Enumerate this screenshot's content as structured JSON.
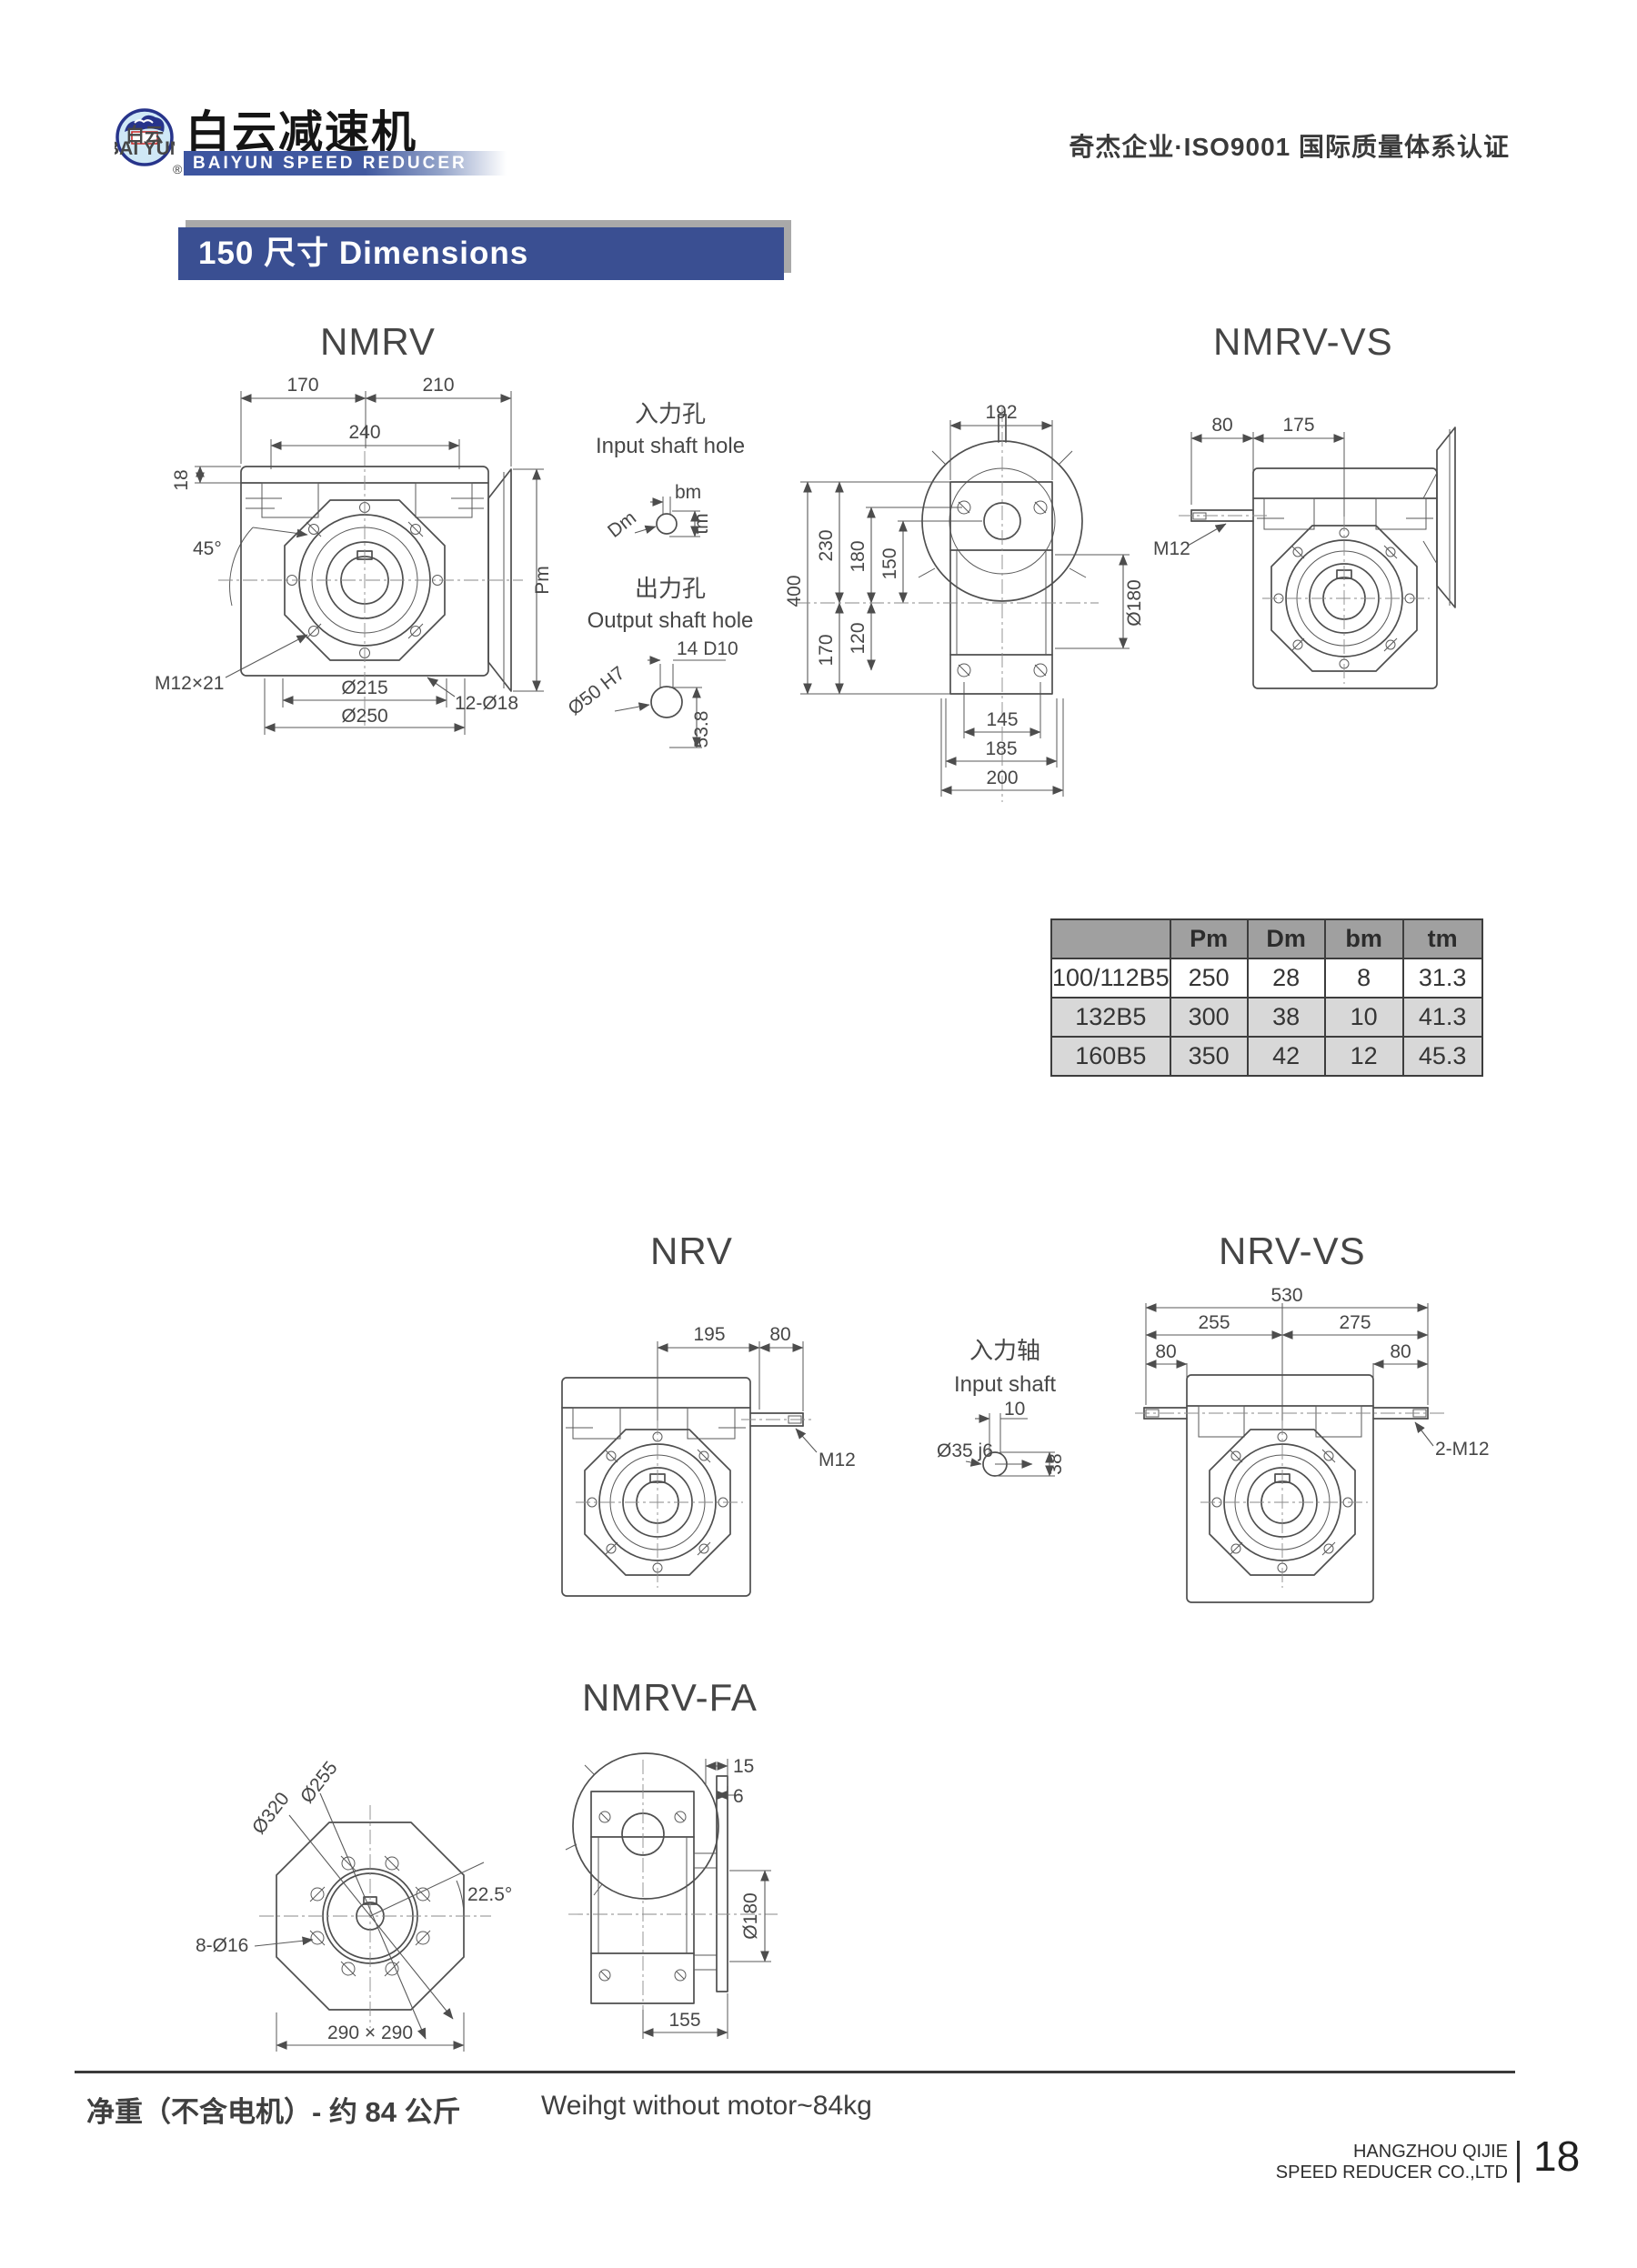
{
  "page": {
    "header": {
      "logo": {
        "badge_cn": "白云",
        "badge_en": "BAI YUN",
        "brand_cn": "白云减速机",
        "brand_en": "BAIYUN SPEED REDUCER",
        "registered": "®"
      },
      "certification": "奇杰企业·ISO9001 国际质量体系认证"
    },
    "section_title": "150 尺寸 Dimensions"
  },
  "nmrv": {
    "title": "NMRV",
    "dims": {
      "w_left": "170",
      "w_right": "210",
      "w_inner": "240",
      "plate": "18",
      "angle": "45°",
      "bolt_spec": "M12×21",
      "bc": "Ø215",
      "od": "Ø250",
      "holes": "12-Ø18",
      "pm": "Pm"
    }
  },
  "shaft_holes": {
    "input_cn": "入力孔",
    "input_en": "Input shaft hole",
    "bm": "bm",
    "dm": "Dm",
    "tm": "tm",
    "output_cn": "出力孔",
    "output_en": "Output shaft hole",
    "key": "14 D10",
    "bore": "Ø50 H7",
    "depth": "53.8"
  },
  "top_view": {
    "dims": {
      "w": "192",
      "h": "400",
      "h1": "230",
      "h2": "180",
      "h3": "150",
      "h4": "120",
      "h5": "170",
      "dia": "Ø180",
      "b1": "145",
      "b2": "185",
      "b3": "200"
    }
  },
  "nmrv_vs": {
    "title": "NMRV-VS",
    "dims": {
      "a": "80",
      "b": "175",
      "m": "M12"
    }
  },
  "nrv": {
    "title": "NRV",
    "dims": {
      "a": "195",
      "b": "80",
      "m": "M12"
    }
  },
  "input_shaft": {
    "cn": "入力轴",
    "en": "Input shaft",
    "dims": {
      "a": "10",
      "dia": "Ø35 j6",
      "b": "38"
    }
  },
  "nrv_vs": {
    "title": "NRV-VS",
    "dims": {
      "total": "530",
      "left": "255",
      "right": "275",
      "a": "80",
      "b": "80",
      "m": "2-M12"
    }
  },
  "nmrv_fa": {
    "title": "NMRV-FA",
    "dims": {
      "bc": "Ø255",
      "od": "Ø320",
      "angle": "22.5°",
      "holes": "8-Ø16",
      "square": "290 × 290",
      "t1": "15",
      "t2": "6",
      "dia": "Ø180",
      "w": "155"
    }
  },
  "table": {
    "headers": [
      "",
      "Pm",
      "Dm",
      "bm",
      "tm"
    ],
    "rows": [
      [
        "100/112B5",
        "250",
        "28",
        "8",
        "31.3"
      ],
      [
        "132B5",
        "300",
        "38",
        "10",
        "41.3"
      ],
      [
        "160B5",
        "350",
        "42",
        "12",
        "45.3"
      ]
    ]
  },
  "footer": {
    "weight_cn": "净重（不含电机）- 约 84 公斤",
    "weight_en": "Weihgt without motor~84kg",
    "company_line1": "HANGZHOU QIJIE",
    "company_line2": "SPEED REDUCER CO.,LTD",
    "divider": "|",
    "page_number": "18"
  }
}
